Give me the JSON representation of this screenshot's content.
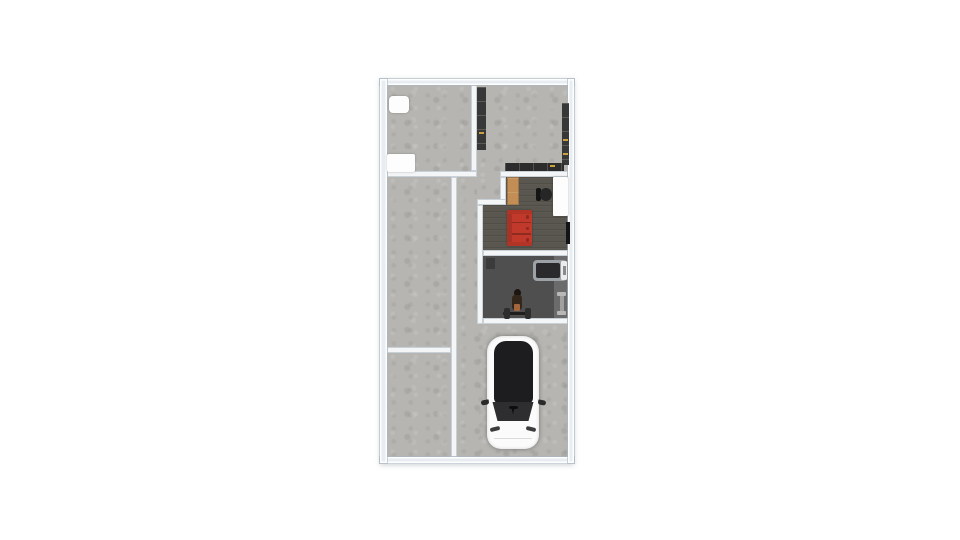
{
  "app": {
    "kind": "floor-plan-render-view",
    "background": "#ffffff"
  },
  "palette": {
    "concrete": "#b6b5b1",
    "wood_dark": "#5a5750",
    "gym_floor": "#4f4f4f",
    "gym_floor_light": "#6b6b6b",
    "wall_fill": "#f3f5f7",
    "wall_outer": "#e9edf1",
    "dark_cabinet": "#383838",
    "counter_dark": "#2c2c2c",
    "gold": "#c9a23f",
    "sofa_red": "#c0392b",
    "sofa_red_dark": "#a93226",
    "sofa_trim": "#b23427",
    "sofa_seam": "#8e2a20",
    "cabinet_tan": "#c28e55",
    "chair_black": "#262626",
    "white_furniture": "#fdfdfd",
    "tv_black": "#141414",
    "treadmill_frame": "#9da2a6",
    "treadmill_belt": "#2a2a2c",
    "car_body": "#fbfbfb",
    "car_glass": "#1d1d1f",
    "car_trim": "#2e2e30"
  },
  "floorplan": {
    "units": "px",
    "bounds": {
      "x": 380,
      "y": 78.5,
      "w": 194,
      "h": 385
    },
    "rooms": [
      {
        "id": "top-left-room"
      },
      {
        "id": "top-right-room"
      },
      {
        "id": "left-upper-room"
      },
      {
        "id": "left-lower-room"
      },
      {
        "id": "hallway"
      },
      {
        "id": "study"
      },
      {
        "id": "gym"
      },
      {
        "id": "garage"
      }
    ],
    "elements": [
      {
        "name": "floor-top-left-room",
        "kind": "concrete",
        "x": 386.5,
        "y": 85,
        "w": 84,
        "h": 85.5,
        "interactable": false
      },
      {
        "name": "floor-top-right-room",
        "kind": "concrete",
        "x": 476.5,
        "y": 85,
        "w": 91,
        "h": 85.5,
        "interactable": false
      },
      {
        "name": "floor-doorway",
        "kind": "concrete",
        "x": 476.5,
        "y": 170.5,
        "w": 23.5,
        "h": 6,
        "interactable": false
      },
      {
        "name": "floor-alcove",
        "kind": "concrete",
        "x": 476.5,
        "y": 176.5,
        "w": 23.5,
        "h": 28,
        "interactable": false
      },
      {
        "name": "floor-hallway",
        "kind": "concrete",
        "x": 456.5,
        "y": 176.5,
        "w": 20,
        "h": 148,
        "interactable": false
      },
      {
        "name": "floor-left-upper-room",
        "kind": "concrete",
        "x": 386.5,
        "y": 176.5,
        "w": 64,
        "h": 170.5,
        "interactable": false
      },
      {
        "name": "floor-left-lower-room",
        "kind": "concrete",
        "x": 386.5,
        "y": 353,
        "w": 64,
        "h": 103.5,
        "interactable": false
      },
      {
        "name": "floor-garage",
        "kind": "concrete",
        "x": 456.5,
        "y": 324,
        "w": 111,
        "h": 132.5,
        "interactable": false
      },
      {
        "name": "floor-study-upper",
        "kind": "wood",
        "x": 506,
        "y": 176.5,
        "w": 61.5,
        "h": 28,
        "interactable": false
      },
      {
        "name": "floor-study-main",
        "kind": "wood",
        "x": 482.5,
        "y": 204.5,
        "w": 85,
        "h": 45.5,
        "interactable": false
      },
      {
        "name": "floor-gym",
        "kind": "gym",
        "x": 482.5,
        "y": 256,
        "w": 85,
        "h": 62,
        "interactable": false
      },
      {
        "name": "floor-gym-light-strip",
        "kind": "accent",
        "x": 553.5,
        "y": 256,
        "w": 14,
        "h": 62,
        "fill": "gym_floor_light",
        "interactable": false
      },
      {
        "name": "wall-outer-top",
        "kind": "wall-outer",
        "x": 380,
        "y": 78.5,
        "w": 194,
        "h": 6.5,
        "interactable": false
      },
      {
        "name": "wall-outer-bottom",
        "kind": "wall-outer",
        "x": 380,
        "y": 456.5,
        "w": 194,
        "h": 6.5,
        "interactable": false
      },
      {
        "name": "wall-outer-left",
        "kind": "wall-outer",
        "x": 380,
        "y": 78.5,
        "w": 6.5,
        "h": 384.5,
        "interactable": false
      },
      {
        "name": "wall-outer-right",
        "kind": "wall-outer",
        "x": 567.5,
        "y": 78.5,
        "w": 6.5,
        "h": 384.5,
        "interactable": false
      },
      {
        "name": "wall-top-rooms-divider",
        "kind": "wall",
        "x": 470.5,
        "y": 85,
        "w": 6,
        "h": 85.5,
        "interactable": false
      },
      {
        "name": "wall-under-top-left",
        "kind": "wall",
        "x": 386.5,
        "y": 170.5,
        "w": 90,
        "h": 6,
        "interactable": false
      },
      {
        "name": "wall-under-top-right",
        "kind": "wall",
        "x": 500,
        "y": 170.5,
        "w": 67.5,
        "h": 6,
        "interactable": false
      },
      {
        "name": "wall-alcove-right",
        "kind": "wall",
        "x": 500,
        "y": 176.5,
        "w": 6,
        "h": 28,
        "interactable": false
      },
      {
        "name": "wall-alcove-bottom",
        "kind": "wall",
        "x": 476.5,
        "y": 198.5,
        "w": 29.5,
        "h": 6,
        "interactable": false
      },
      {
        "name": "wall-hallway-right",
        "kind": "wall",
        "x": 476.5,
        "y": 204.5,
        "w": 6,
        "h": 119.5,
        "interactable": false
      },
      {
        "name": "wall-left-column-divider",
        "kind": "wall",
        "x": 450.5,
        "y": 176.5,
        "w": 6,
        "h": 280,
        "interactable": false
      },
      {
        "name": "wall-left-rooms-divider",
        "kind": "wall",
        "x": 386.5,
        "y": 347,
        "w": 64,
        "h": 6,
        "interactable": false
      },
      {
        "name": "wall-study-gym-divider",
        "kind": "wall",
        "x": 482.5,
        "y": 250,
        "w": 85,
        "h": 6,
        "interactable": false
      },
      {
        "name": "wall-gym-bottom",
        "kind": "wall",
        "x": 482.5,
        "y": 318,
        "w": 85,
        "h": 6,
        "interactable": false
      },
      {
        "name": "white-appliance-small",
        "kind": "furn",
        "x": 388.5,
        "y": 95.5,
        "w": 20,
        "h": 17,
        "fill": "white_furniture",
        "r": "4px",
        "shadow": "0 0 2px rgba(0,0,0,.25)",
        "interactable": true
      },
      {
        "name": "white-appliance-large",
        "kind": "furn",
        "x": 387,
        "y": 154,
        "w": 27.5,
        "h": 18,
        "fill": "white_furniture",
        "r": "2px",
        "shadow": "0 0 2px rgba(0,0,0,.25)",
        "interactable": true
      },
      {
        "name": "wardrobe",
        "kind": "furn",
        "x": 477,
        "y": 87,
        "w": 8.5,
        "h": 63,
        "fill": "dark_cabinet",
        "seg": "v",
        "interactable": true
      },
      {
        "name": "wardrobe-handle",
        "kind": "furn",
        "x": 478.5,
        "y": 131.5,
        "w": 5.5,
        "h": 2,
        "fill": "gold",
        "interactable": false
      },
      {
        "name": "shelf-unit-right",
        "kind": "furn",
        "x": 561.5,
        "y": 103,
        "w": 7,
        "h": 62,
        "fill": "dark_cabinet",
        "seg": "v",
        "interactable": true
      },
      {
        "name": "shelf-handle-1",
        "kind": "furn",
        "x": 562.5,
        "y": 139,
        "w": 5,
        "h": 2,
        "fill": "gold",
        "interactable": false
      },
      {
        "name": "shelf-handle-2",
        "kind": "furn",
        "x": 562.5,
        "y": 152.5,
        "w": 5,
        "h": 2,
        "fill": "gold",
        "interactable": false
      },
      {
        "name": "kitchen-counter",
        "kind": "furn",
        "x": 504.5,
        "y": 162.5,
        "w": 59,
        "h": 8.5,
        "fill": "counter_dark",
        "seg": "h",
        "interactable": true
      },
      {
        "name": "counter-handle",
        "kind": "furn",
        "x": 549.5,
        "y": 164.5,
        "w": 5,
        "h": 2,
        "fill": "gold",
        "interactable": false
      },
      {
        "name": "tall-cabinet-tan",
        "kind": "furn",
        "x": 506.5,
        "y": 176.5,
        "w": 12.5,
        "h": 28,
        "fill": "cabinet_tan",
        "seg": "v",
        "border": "1px solid rgba(90,60,30,.35)",
        "interactable": true
      },
      {
        "name": "office-chair-back",
        "kind": "furn",
        "x": 535.5,
        "y": 187.5,
        "w": 5.5,
        "h": 13,
        "fill": "tv_black",
        "r": "2px",
        "interactable": false
      },
      {
        "name": "office-chair-seat",
        "kind": "furn",
        "x": 540,
        "y": 187.5,
        "w": 12,
        "h": 13.5,
        "fill": "chair_black",
        "r": "50%",
        "interactable": true
      },
      {
        "name": "desk-white",
        "kind": "furn",
        "x": 552.5,
        "y": 176.5,
        "w": 15,
        "h": 39,
        "fill": "white_furniture",
        "r": "1px",
        "shadow": "0 0 2px rgba(0,0,0,.3)",
        "interactable": true
      },
      {
        "name": "wall-tv",
        "kind": "furn",
        "x": 566,
        "y": 221.5,
        "w": 3.5,
        "h": 22,
        "fill": "tv_black",
        "interactable": true
      },
      {
        "name": "sofa-base",
        "kind": "furn",
        "x": 506.5,
        "y": 209.5,
        "w": 25,
        "h": 36.5,
        "fill": "sofa_red",
        "r": "2px",
        "shadow": "0 0 2px rgba(0,0,0,.3)",
        "interactable": true
      },
      {
        "name": "sofa-backrest",
        "kind": "furn",
        "x": 506.5,
        "y": 209.5,
        "w": 5.5,
        "h": 36.5,
        "fill": "sofa_red_dark",
        "r": "2px 0 0 2px",
        "interactable": false
      },
      {
        "name": "sofa-armrest-top",
        "kind": "furn",
        "x": 506.5,
        "y": 209.5,
        "w": 25,
        "h": 4,
        "fill": "sofa_trim",
        "r": "2px 2px 0 0",
        "interactable": false
      },
      {
        "name": "sofa-armrest-bottom",
        "kind": "furn",
        "x": 506.5,
        "y": 242,
        "w": 25,
        "h": 4,
        "fill": "sofa_trim",
        "r": "0 0 2px 2px",
        "interactable": false
      },
      {
        "name": "sofa-seam-1",
        "kind": "furn",
        "x": 512,
        "y": 221.5,
        "w": 19,
        "h": 1.5,
        "fill": "sofa_seam",
        "interactable": false
      },
      {
        "name": "sofa-seam-2",
        "kind": "furn",
        "x": 512,
        "y": 233,
        "w": 19,
        "h": 1.5,
        "fill": "sofa_seam",
        "interactable": false
      },
      {
        "name": "sofa-knob-1",
        "kind": "furn",
        "x": 525.5,
        "y": 215,
        "w": 3.5,
        "h": 3.5,
        "fill": "sofa_seam",
        "r": "50%",
        "interactable": false
      },
      {
        "name": "sofa-knob-2",
        "kind": "furn",
        "x": 525.5,
        "y": 226.5,
        "w": 3.5,
        "h": 3.5,
        "fill": "sofa_seam",
        "r": "50%",
        "interactable": false
      },
      {
        "name": "sofa-knob-3",
        "kind": "furn",
        "x": 525.5,
        "y": 238,
        "w": 3.5,
        "h": 3.5,
        "fill": "sofa_seam",
        "r": "50%",
        "interactable": false
      },
      {
        "name": "gym-corner-mat",
        "kind": "furn",
        "x": 486,
        "y": 257.5,
        "w": 9,
        "h": 11,
        "fill": "#3b3b3b",
        "interactable": true
      },
      {
        "name": "treadmill-frame",
        "kind": "furn",
        "x": 533,
        "y": 260,
        "w": 33.5,
        "h": 20.5,
        "fill": "treadmill_frame",
        "r": "4px",
        "interactable": true
      },
      {
        "name": "treadmill-belt",
        "kind": "furn",
        "x": 535.5,
        "y": 262.5,
        "w": 24,
        "h": 15.5,
        "fill": "treadmill_belt",
        "r": "2px",
        "interactable": false
      },
      {
        "name": "treadmill-console",
        "kind": "furn",
        "x": 561,
        "y": 261,
        "w": 6,
        "h": 18.5,
        "fill": "#ececec",
        "r": "1.5px",
        "interactable": false
      },
      {
        "name": "treadmill-console-detail",
        "kind": "furn",
        "x": 562.5,
        "y": 265.5,
        "w": 3,
        "h": 9,
        "fill": "#8b8b8b",
        "interactable": false
      },
      {
        "name": "bench-headrest",
        "kind": "furn",
        "x": 513.5,
        "y": 289,
        "w": 7,
        "h": 8,
        "fill": "#1c150f",
        "r": "50%",
        "interactable": false
      },
      {
        "name": "bench-body",
        "kind": "furn",
        "x": 511.5,
        "y": 295,
        "w": 10.5,
        "h": 15,
        "fill": "#33261a",
        "r": "3px",
        "interactable": true
      },
      {
        "name": "bench-cushion",
        "kind": "furn",
        "x": 513.5,
        "y": 304,
        "w": 6.5,
        "h": 7,
        "fill": "#a4663c",
        "r": "1px",
        "interactable": false
      },
      {
        "name": "barbell-bar",
        "kind": "furn",
        "x": 503,
        "y": 311.5,
        "w": 28,
        "h": 3,
        "fill": "#1f1f1f",
        "r": "1.5px",
        "interactable": true
      },
      {
        "name": "barbell-plate-left",
        "kind": "furn",
        "x": 504,
        "y": 307.5,
        "w": 5.5,
        "h": 11,
        "fill": "#2d2d2d",
        "r": "2px",
        "interactable": false
      },
      {
        "name": "barbell-plate-right",
        "kind": "furn",
        "x": 525,
        "y": 307.5,
        "w": 5.5,
        "h": 11,
        "fill": "#2d2d2d",
        "r": "2px",
        "interactable": false
      },
      {
        "name": "dumbbell-rack-top",
        "kind": "furn",
        "x": 557,
        "y": 292,
        "w": 9,
        "h": 4,
        "fill": "#b8b8b8",
        "r": "1px",
        "interactable": false
      },
      {
        "name": "dumbbell-rack-post",
        "kind": "furn",
        "x": 559.5,
        "y": 295.5,
        "w": 4,
        "h": 16,
        "fill": "#a0a0a0",
        "interactable": true
      },
      {
        "name": "dumbbell-rack-bottom",
        "kind": "furn",
        "x": 557,
        "y": 311,
        "w": 9,
        "h": 4,
        "fill": "#b8b8b8",
        "r": "1px",
        "interactable": false
      },
      {
        "name": "car-body",
        "kind": "furn",
        "x": 487,
        "y": 336,
        "w": 52,
        "h": 113,
        "fill": "car_body",
        "r": "16px 16px 14px 14px",
        "shadow": "0 0 5px rgba(0,0,0,.35), inset 0 0 3px rgba(0,0,0,.15)",
        "interactable": true
      },
      {
        "name": "car-glass-roof",
        "kind": "furn",
        "x": 493.5,
        "y": 340.5,
        "w": 39,
        "h": 63,
        "fill": "car_glass",
        "r": "12px 12px 6px 6px",
        "interactable": false
      },
      {
        "name": "car-windshield",
        "kind": "furn",
        "x": 491.5,
        "y": 401.5,
        "w": 43,
        "h": 19.5,
        "fill": "car_trim",
        "clip": "polygon(2% 0, 98% 0, 86% 100%, 14% 100%)",
        "interactable": false
      },
      {
        "name": "car-logo-top",
        "kind": "furn",
        "x": 508.5,
        "y": 406,
        "w": 9,
        "h": 2.5,
        "fill": "#0d0d0d",
        "r": "40%",
        "interactable": false
      },
      {
        "name": "car-logo-stem",
        "kind": "furn",
        "x": 511.5,
        "y": 407.5,
        "w": 3,
        "h": 7,
        "fill": "#0d0d0d",
        "clip": "polygon(0 0, 100% 0, 50% 100%)",
        "interactable": false
      },
      {
        "name": "car-mirror-left",
        "kind": "furn",
        "x": 481,
        "y": 400,
        "w": 7.5,
        "h": 5,
        "fill": "#2a2a2a",
        "r": "4px 1px 4px 4px",
        "rot": -10,
        "interactable": false
      },
      {
        "name": "car-mirror-right",
        "kind": "furn",
        "x": 537.5,
        "y": 400,
        "w": 7.5,
        "h": 5,
        "fill": "#2a2a2a",
        "r": "1px 4px 4px 4px",
        "rot": 10,
        "interactable": false
      },
      {
        "name": "car-headlight-left",
        "kind": "furn",
        "x": 490,
        "y": 426.5,
        "w": 10,
        "h": 4,
        "fill": "#3c3c3c",
        "r": "2px",
        "rot": -14,
        "interactable": false
      },
      {
        "name": "car-headlight-right",
        "kind": "furn",
        "x": 526,
        "y": 426.5,
        "w": 10,
        "h": 4,
        "fill": "#3c3c3c",
        "r": "2px",
        "rot": 14,
        "interactable": false
      },
      {
        "name": "car-bumper-line",
        "kind": "furn",
        "x": 494,
        "y": 437.5,
        "w": 38,
        "h": 1.5,
        "fill": "#dcdcdc",
        "r": "1px",
        "interactable": false
      }
    ]
  }
}
